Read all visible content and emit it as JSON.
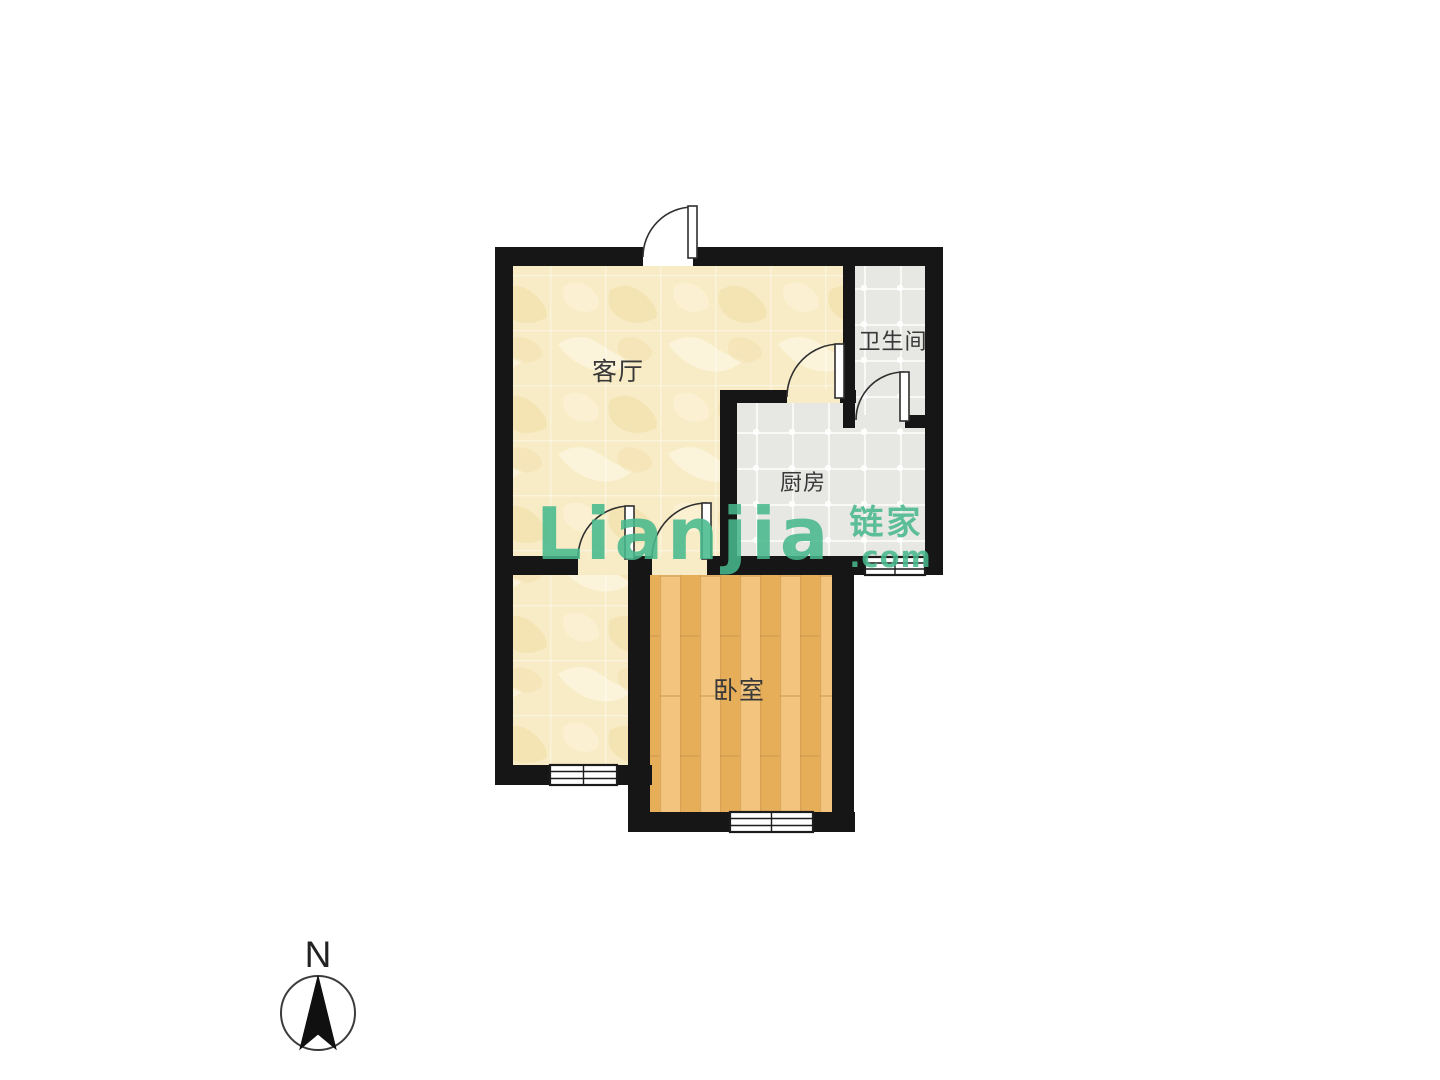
{
  "rooms": {
    "living_room": {
      "label": "客厅"
    },
    "bathroom": {
      "label": "卫生间"
    },
    "kitchen": {
      "label": "厨房"
    },
    "bedroom": {
      "label": "卧室"
    }
  },
  "watermark": {
    "latin": "Lianjia",
    "chinese": "链家",
    "domain": ".com"
  },
  "compass": {
    "north_label": "N"
  },
  "colors": {
    "wall": "#161616",
    "beige": "#f8ecc6",
    "wood": "#ecba6a",
    "tile": "#e7e7e4",
    "label_text": "#383838",
    "watermark_green": "#47b98d",
    "page_bg": "#ffffff"
  }
}
